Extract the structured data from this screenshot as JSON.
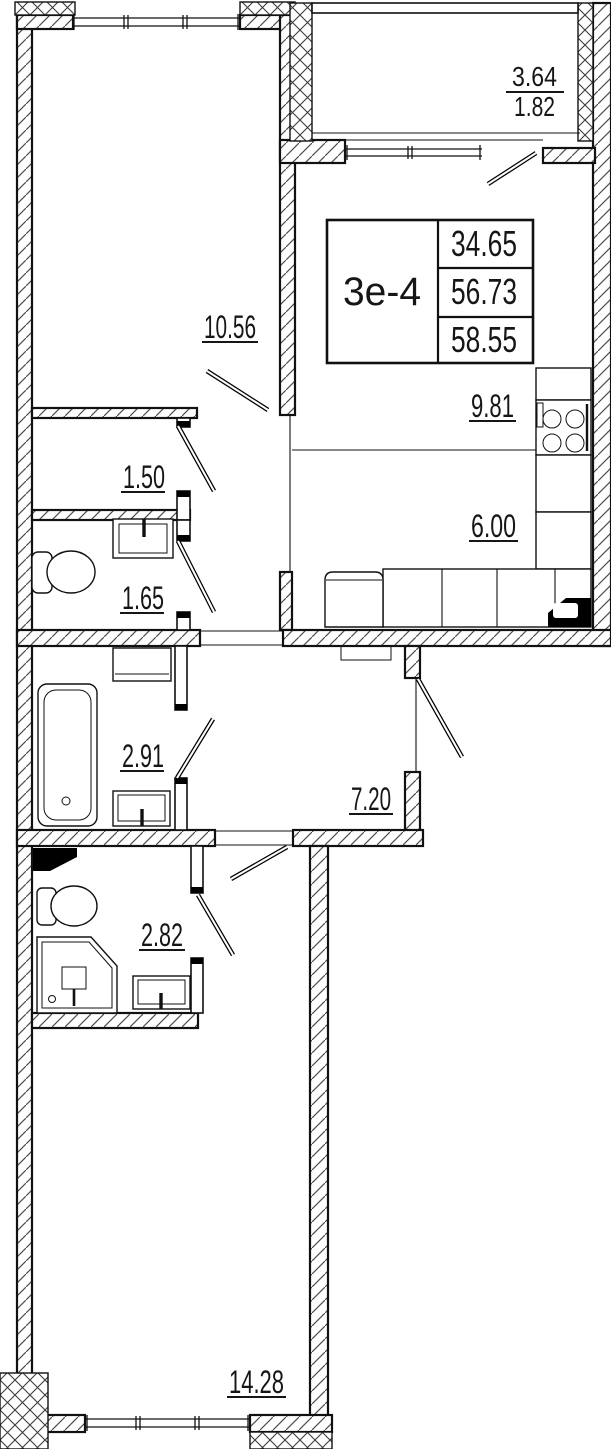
{
  "plan": {
    "unit": {
      "type_label": "3е-4",
      "living_area": "34.65",
      "apartment_area": "56.73",
      "total_area": "58.55"
    },
    "balcony": {
      "area_full": "3.64",
      "area_reduced": "1.82"
    },
    "rooms": {
      "bedroom_upper": "10.56",
      "hall_small": "1.50",
      "wc": "1.65",
      "kitchen_zone": "9.81",
      "dining_zone": "6.00",
      "bathroom": "2.91",
      "hallway": "7.20",
      "shower_room": "2.82",
      "bedroom_lower": "14.28"
    },
    "colors": {
      "ink": "#161616",
      "paper": "#ffffff"
    }
  }
}
